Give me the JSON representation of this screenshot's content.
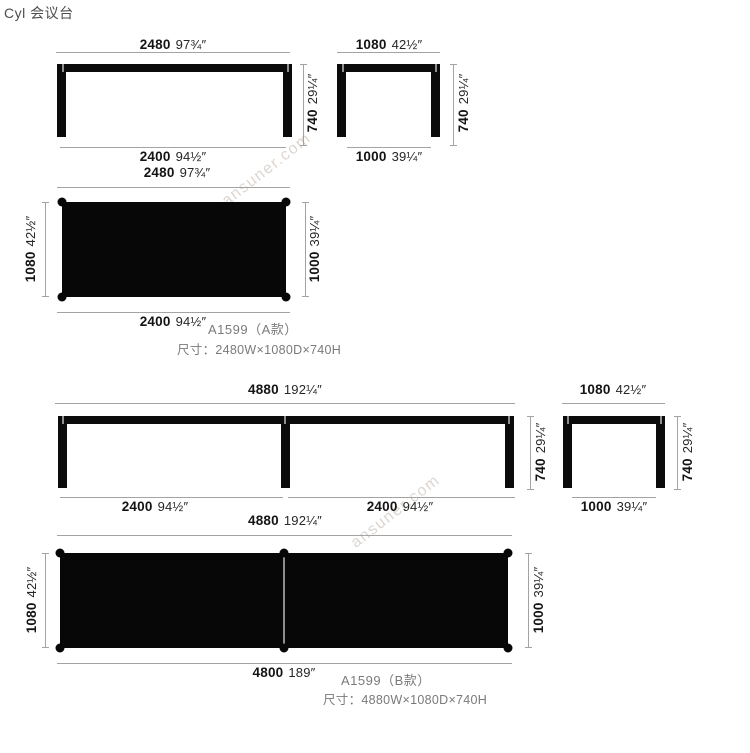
{
  "title": "Cyl 会议台",
  "watermark": "ansuner.com",
  "colors": {
    "ink": "#0b0b0b",
    "dim_line": "#a3a3a3",
    "label_gray": "#7a7a7a",
    "watermark": "#bcaca0",
    "background": "#ffffff"
  },
  "model_a": {
    "code": "A1599（A款）",
    "size": "尺寸：2480W×1080D×740H",
    "front": {
      "width_mm": "2480",
      "width_in": "97¾″",
      "base_mm": "2400",
      "base_in": "94½″",
      "height_mm": "740",
      "height_in": "29¼″"
    },
    "side": {
      "width_mm": "1080",
      "width_in": "42½″",
      "base_mm": "1000",
      "base_in": "39¼″",
      "height_mm": "740",
      "height_in": "29¼″"
    },
    "plan": {
      "width_mm": "2480",
      "width_in": "97¾″",
      "depth_mm": "1080",
      "depth_in": "42½″",
      "depth_floor_mm": "1000",
      "depth_floor_in": "39¼″",
      "base_mm": "2400",
      "base_in": "94½″"
    }
  },
  "model_b": {
    "code": "A1599（B款）",
    "size": "尺寸：4880W×1080D×740H",
    "front": {
      "width_mm": "4880",
      "width_in": "192¼″",
      "seg1_mm": "2400",
      "seg1_in": "94½″",
      "seg2_mm": "2400",
      "seg2_in": "94½″",
      "height_mm": "740",
      "height_in": "29¼″"
    },
    "side": {
      "width_mm": "1080",
      "width_in": "42½″",
      "base_mm": "1000",
      "base_in": "39¼″",
      "height_mm": "740",
      "height_in": "29¼″"
    },
    "plan": {
      "width_mm": "4880",
      "width_in": "192¼″",
      "depth_mm": "1080",
      "depth_in": "42½″",
      "depth_floor_mm": "1000",
      "depth_floor_in": "39¼″",
      "base_mm": "4800",
      "base_in": "189″"
    }
  }
}
